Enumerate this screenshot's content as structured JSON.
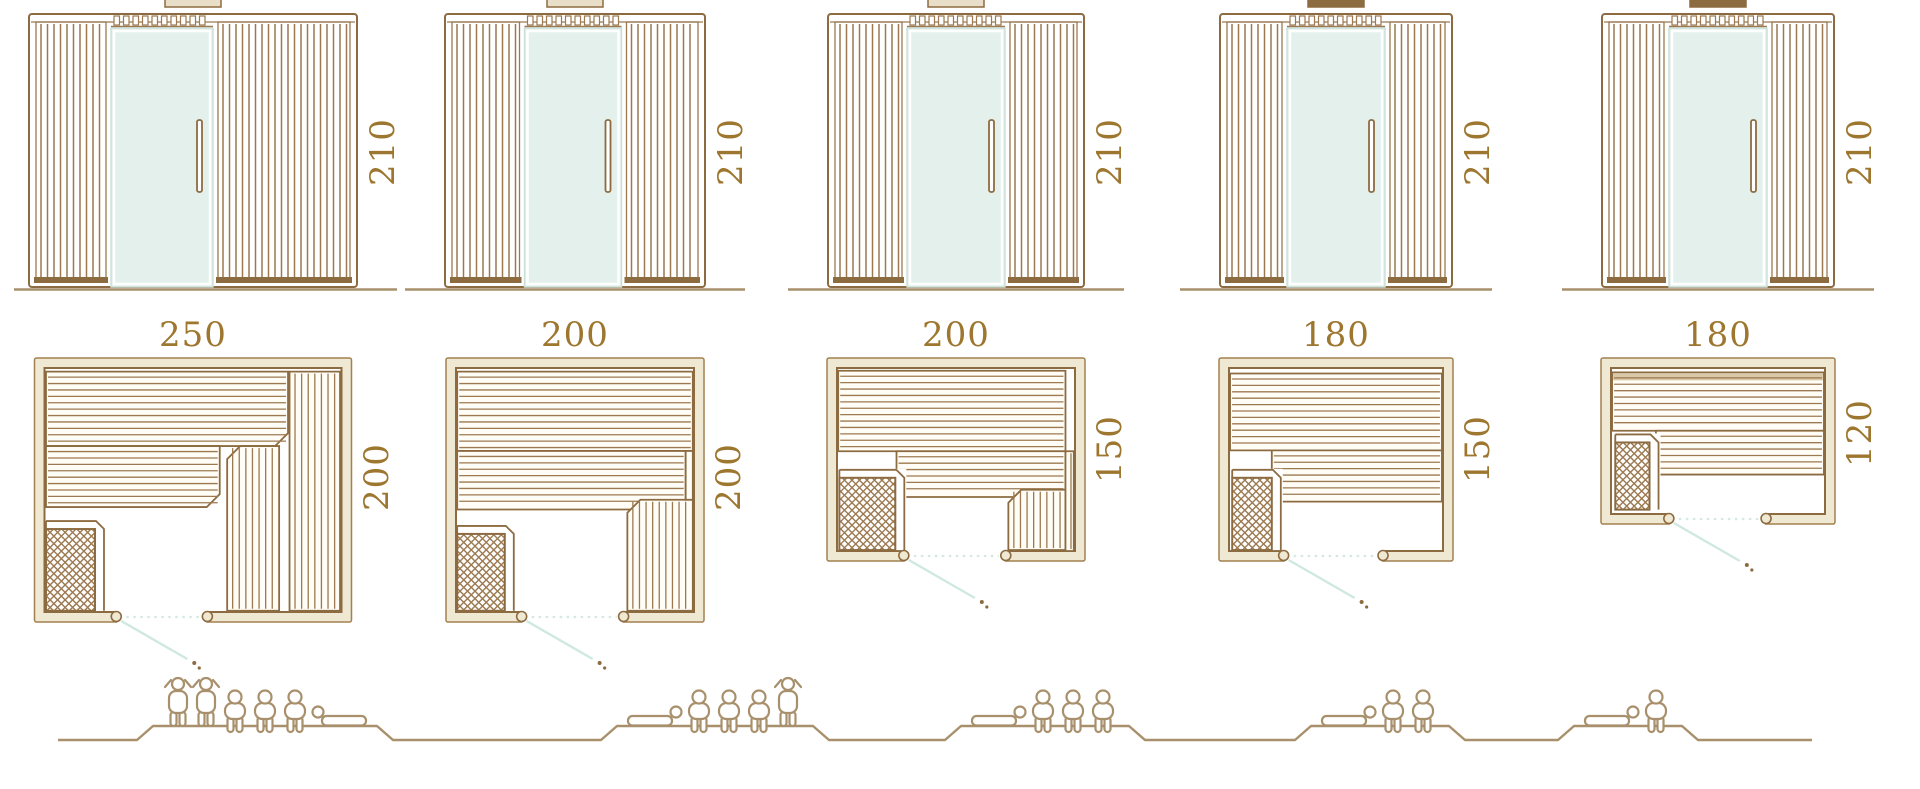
{
  "units": [
    {
      "width_label": "250",
      "depth_label": "200",
      "height_label": "210",
      "width_cm": 250,
      "depth_cm": 200,
      "height_cm": 210,
      "capacity_persons": 6,
      "capacity_breakdown": {
        "standing": 2,
        "sitting": 3,
        "lying": 1
      }
    },
    {
      "width_label": "200",
      "depth_label": "200",
      "height_label": "210",
      "width_cm": 200,
      "depth_cm": 200,
      "height_cm": 210,
      "capacity_persons": 5,
      "capacity_breakdown": {
        "standing": 1,
        "sitting": 3,
        "lying": 1
      }
    },
    {
      "width_label": "200",
      "depth_label": "150",
      "height_label": "210",
      "width_cm": 200,
      "depth_cm": 150,
      "height_cm": 210,
      "capacity_persons": 4,
      "capacity_breakdown": {
        "standing": 0,
        "sitting": 3,
        "lying": 1
      }
    },
    {
      "width_label": "180",
      "depth_label": "150",
      "height_label": "210",
      "width_cm": 180,
      "depth_cm": 150,
      "height_cm": 210,
      "capacity_persons": 3,
      "capacity_breakdown": {
        "standing": 0,
        "sitting": 2,
        "lying": 1
      }
    },
    {
      "width_label": "180",
      "depth_label": "120",
      "height_label": "210",
      "width_cm": 180,
      "depth_cm": 120,
      "height_cm": 210,
      "capacity_persons": 2,
      "capacity_breakdown": {
        "standing": 0,
        "sitting": 1,
        "lying": 1
      }
    }
  ],
  "colors": {
    "outline": "#8d6b41",
    "slat": "#9c7950",
    "wall_fill": "#efe8d3",
    "bench_fill": "#fffdf6",
    "bench_dark_strip": "#d9c9a7",
    "glass": "#e4f0ec",
    "glass_edge": "#cadfd8",
    "glass_frame": "#ffffff",
    "door_swing": "#cfe8e1",
    "dotted_line": "#d7e8e1",
    "dimension_text": "#9d762f",
    "figure_outline": "#a8906c",
    "ground": "#a8906c",
    "tab_dark": "#8d6b41",
    "tab_light": "#e9dfc8"
  }
}
